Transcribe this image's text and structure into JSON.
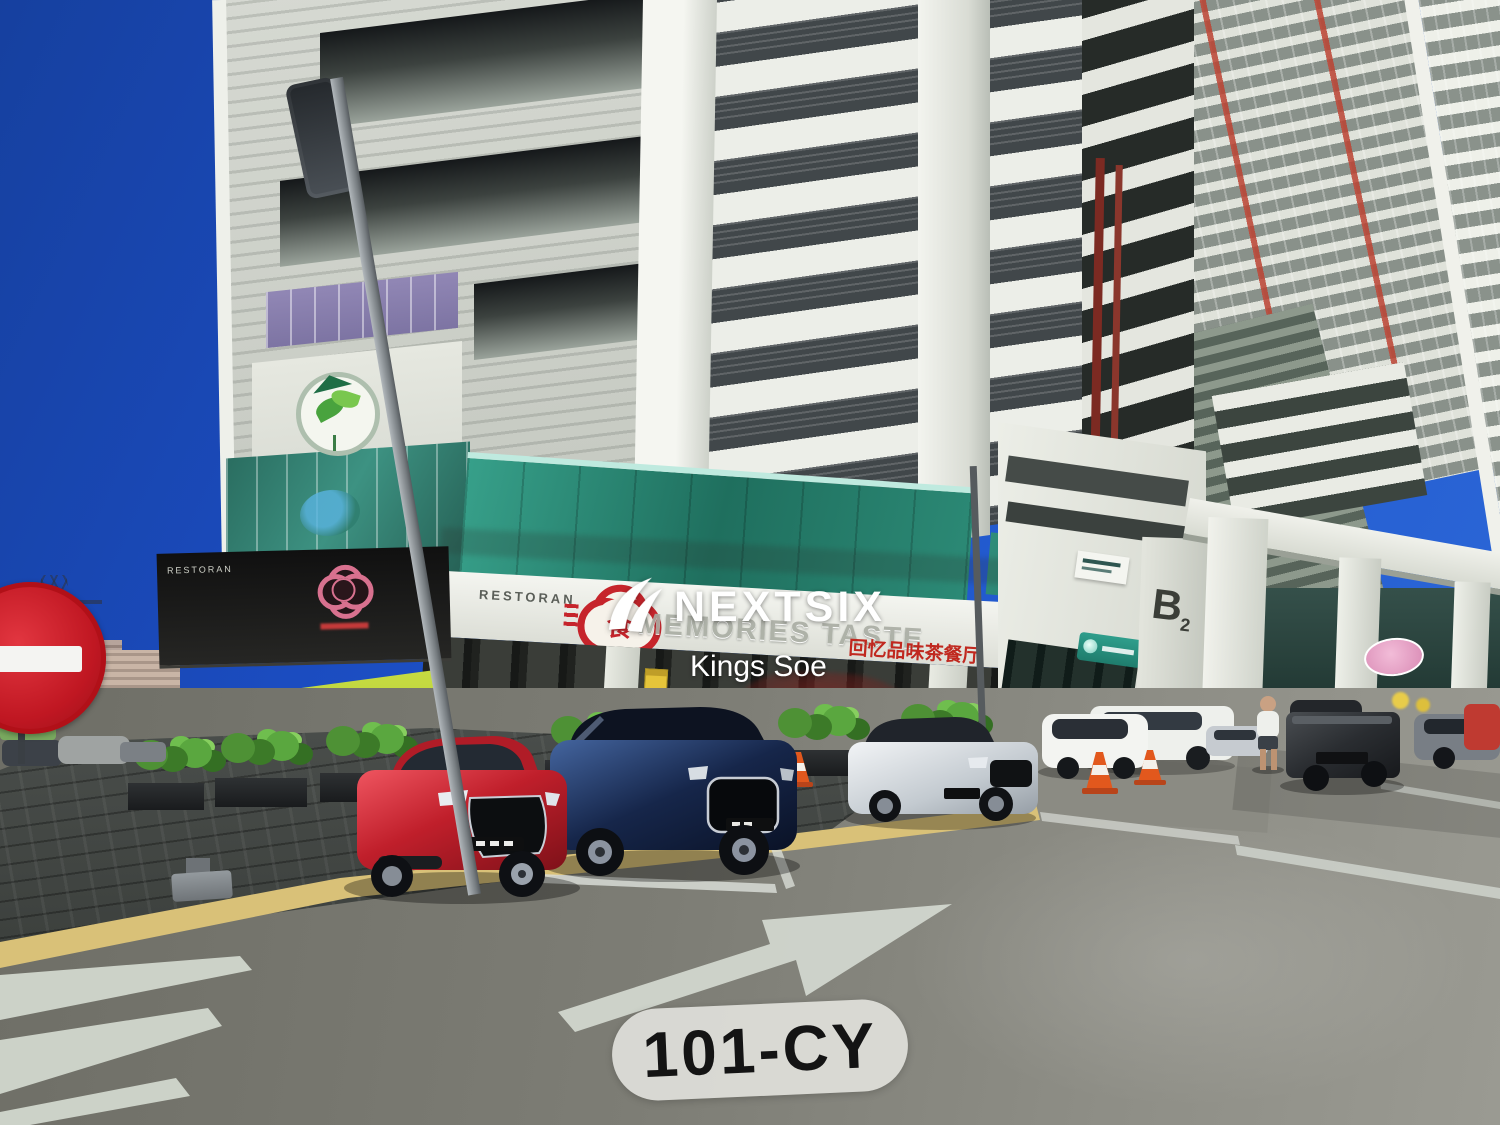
{
  "photo": {
    "type": "street-photo-of-mixed-use-building",
    "label_tag": "101-CY"
  },
  "watermark": {
    "brand": "NEXTSIX",
    "agent_name": "Kings Soe"
  },
  "building_signs": {
    "left_shop_fascia": "RESTORAN",
    "center_shop_fascia": "RESTORAN",
    "channel_letter_sign": "MEMORIES TASTE",
    "chinese_sign": "回忆品味茶餐厅",
    "food_logo_glyph": "食",
    "block_label": "B",
    "block_label_subscript": "2"
  },
  "icons": {
    "watermark_logo": "nextsix-swoosh-icon",
    "no_entry": "no-entry-sign-icon",
    "road_arrow": "right-turn-arrow-marking",
    "green_logo": "leaf-education-logo-icon",
    "red_flower_logo": "flower-food-logo-icon",
    "pink_flower_logo": "flower-restaurant-logo-icon"
  },
  "palette": {
    "sky": "#1e4fc6",
    "building_light": "#e9ebe4",
    "building_dark_louver": "#41474a",
    "teal_glass": "#2f8d7a",
    "awning_green": "#c3d83c",
    "sign_red": "#c0281f",
    "car_red": "#c01f2b",
    "car_navy": "#1e3054",
    "label_bg": "#dcdcd8",
    "label_text": "#141414",
    "road": "#7d7d75"
  }
}
